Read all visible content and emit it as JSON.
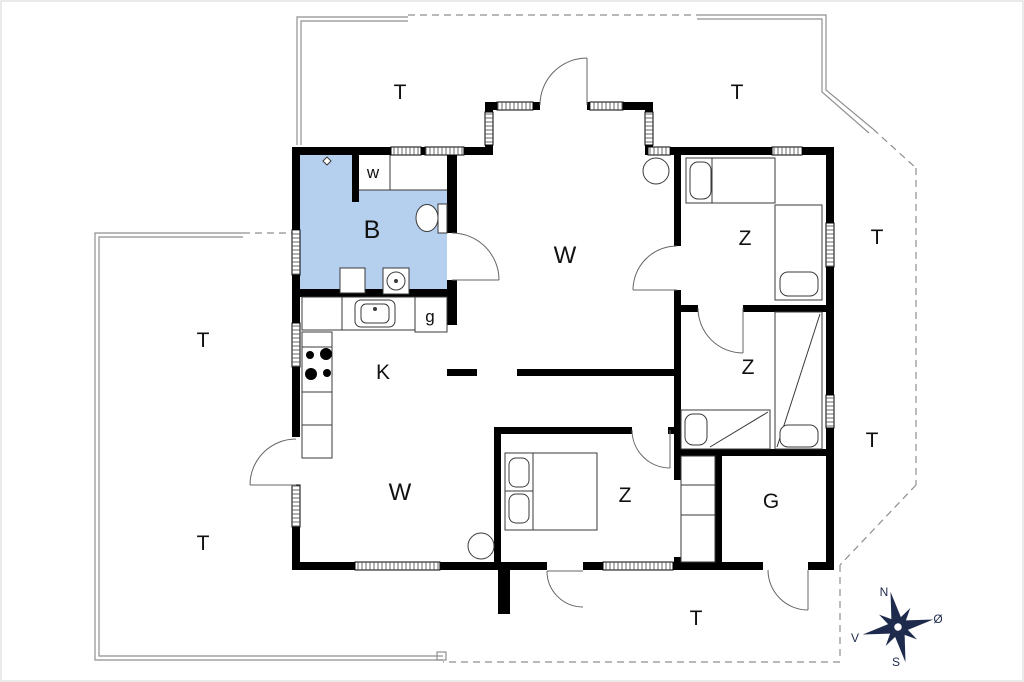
{
  "page": {
    "background": "#ffffff",
    "border": "#d5d5d5"
  },
  "colors": {
    "wall": "#000000",
    "bathroom_fill": "#b5cfee",
    "furniture": "#3a3a3a",
    "door": "#666666",
    "terrace": "#8f8f8f",
    "compass": "#1e2b4c",
    "label": "#111111"
  },
  "rooms": {
    "bathroom": {
      "label": "B"
    },
    "bathroom_closet": {
      "label": "w"
    },
    "living_room_top": {
      "label": "W"
    },
    "living_room_bottom": {
      "label": "W"
    },
    "kitchen": {
      "label": "K"
    },
    "guest_wc": {
      "label": "g"
    },
    "bedroom_top_right": {
      "label": "Z"
    },
    "bedroom_middle_right": {
      "label": "Z"
    },
    "bedroom_bottom": {
      "label": "Z"
    },
    "storage": {
      "label": "G"
    }
  },
  "terraces": {
    "top_left": {
      "label": "T"
    },
    "top_right": {
      "label": "T"
    },
    "right_upper": {
      "label": "T"
    },
    "right_lower": {
      "label": "T"
    },
    "left_upper": {
      "label": "T"
    },
    "left_lower": {
      "label": "T"
    },
    "bottom": {
      "label": "T"
    }
  },
  "compass": {
    "north": "N",
    "east": "Ø",
    "south": "S",
    "west": "V"
  }
}
